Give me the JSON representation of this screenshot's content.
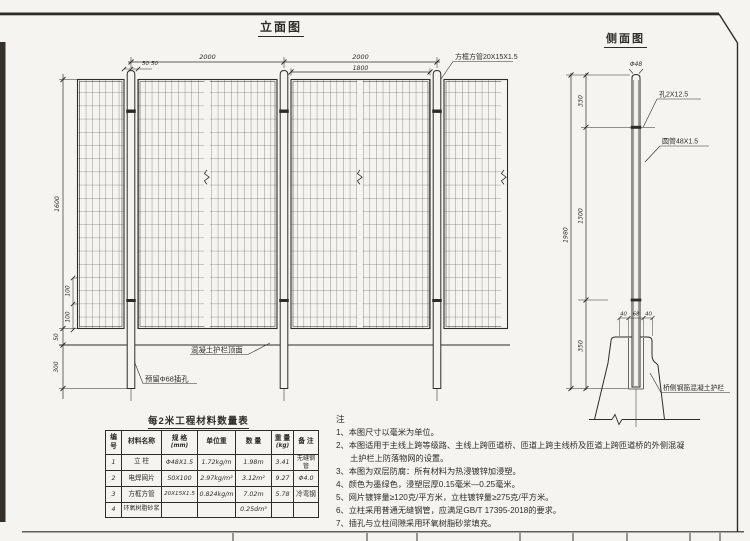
{
  "front_view": {
    "title": "立面图",
    "dims": {
      "span1": "2000",
      "span2": "2000",
      "panel": "1800",
      "gap1": "50",
      "gap2": "50",
      "height": "1600",
      "row1": "100",
      "row2": "100",
      "clearance": "50",
      "embed": "300"
    },
    "labels": {
      "frame_tube": "方框方管20X15X1.5",
      "concrete_top": "混凝土护栏顶面",
      "insert_hole": "预留Φ68插孔"
    }
  },
  "side_view": {
    "title": "侧面图",
    "dims": {
      "post_dia": "Φ48",
      "top": "330",
      "mid": "1300",
      "embed": "350",
      "total": "1980",
      "base_left": "40",
      "base_mid": "68",
      "base_right": "40"
    },
    "labels": {
      "hole": "孔2X12.5",
      "tube": "圆管48X1.5",
      "barrier": "桥侧钢筋混凝土护栏"
    }
  },
  "materials_table": {
    "title": "每2米工程材料数量表",
    "headers": {
      "no_l1": "编",
      "no_l2": "号",
      "name": "材料名称",
      "spec_l1": "规 格",
      "spec_l2": "(mm)",
      "unit": "单位重",
      "qty": "数 量",
      "weight_l1": "重 量",
      "weight_l2": "(kg)",
      "remark": "备 注"
    },
    "rows": [
      {
        "no": "1",
        "name": "立 柱",
        "spec": "Φ48X1.5",
        "unit": "1.72kg/m",
        "qty": "1.98m",
        "weight": "3.41",
        "remark": "无缝钢管"
      },
      {
        "no": "2",
        "name": "电焊网片",
        "spec": "50X100",
        "unit": "2.97kg/m²",
        "qty": "3.12m²",
        "weight": "9.27",
        "remark": "Φ4.0"
      },
      {
        "no": "3",
        "name": "方框方管",
        "spec": "20X15X1.5",
        "unit": "0.824kg/m",
        "qty": "7.02m",
        "weight": "5.78",
        "remark": "冷弯钢"
      },
      {
        "no": "4",
        "name": "环氧树脂砂浆",
        "spec": "",
        "unit": "",
        "qty": "0.25dm³",
        "weight": "",
        "remark": ""
      }
    ]
  },
  "notes": {
    "heading": "注",
    "items": [
      "1、本图尺寸以毫米为单位。",
      "2、本图适用于主线上跨等级路、主线上跨匝道桥、匝道上跨主线桥及匝道上跨匝道桥的外侧混凝土护栏上防落物网的设置。",
      "3、本图为双层防腐：所有材料为热浸镀锌加浸塑。",
      "4、颜色为墨绿色，浸塑层厚0.15毫米—0.25毫米。",
      "5、网片镀锌量≥120克/平方米，立柱镀锌量≥275克/平方米。",
      "6、立柱采用普通无缝钢管，应满足GB/T 17395-2018的要求。",
      "7、插孔与立柱间隙采用环氧树脂砂浆填充。"
    ]
  },
  "colors": {
    "line": "#2e2c28",
    "paper": "#f5f4f0"
  }
}
